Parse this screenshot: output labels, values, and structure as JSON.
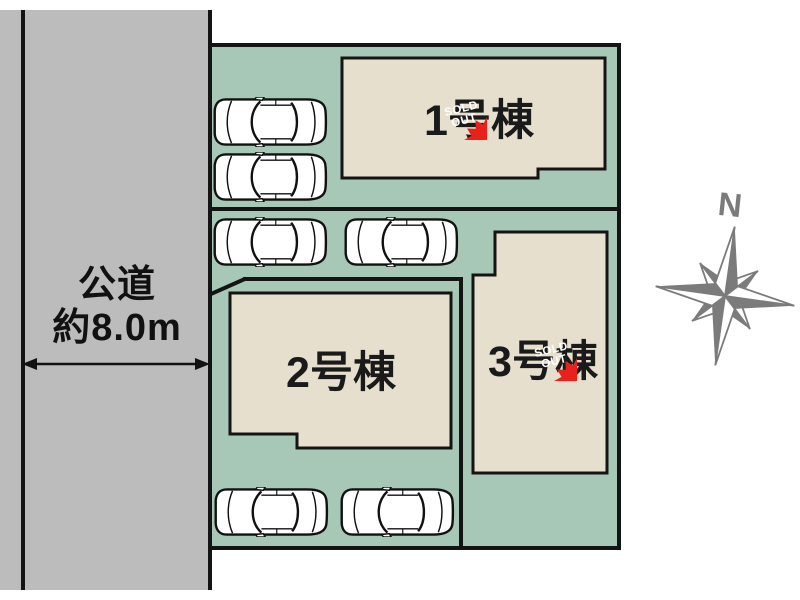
{
  "diagram_type": "real-estate-site-plan",
  "road": {
    "label_line1": "公道",
    "label_line2": "約8.0m",
    "has_width_arrow": true
  },
  "buildings": [
    {
      "label": "1号棟",
      "sold_out": true
    },
    {
      "label": "2号棟",
      "sold_out": false
    },
    {
      "label": "3号棟",
      "sold_out": true
    }
  ],
  "badge": {
    "line1": "SOLD",
    "line2": "OUT"
  },
  "compass": {
    "label": "N"
  },
  "parking": {
    "car_count": 6
  },
  "colors": {
    "road_gray": "#bcbcbc",
    "plot_green": "#a7c8b6",
    "building_beige": "#e7dfcd",
    "outline_black": "#141414",
    "badge_red": "#e8211d",
    "badge_text": "#ffffff",
    "compass_gray": "#7b7b7b"
  }
}
